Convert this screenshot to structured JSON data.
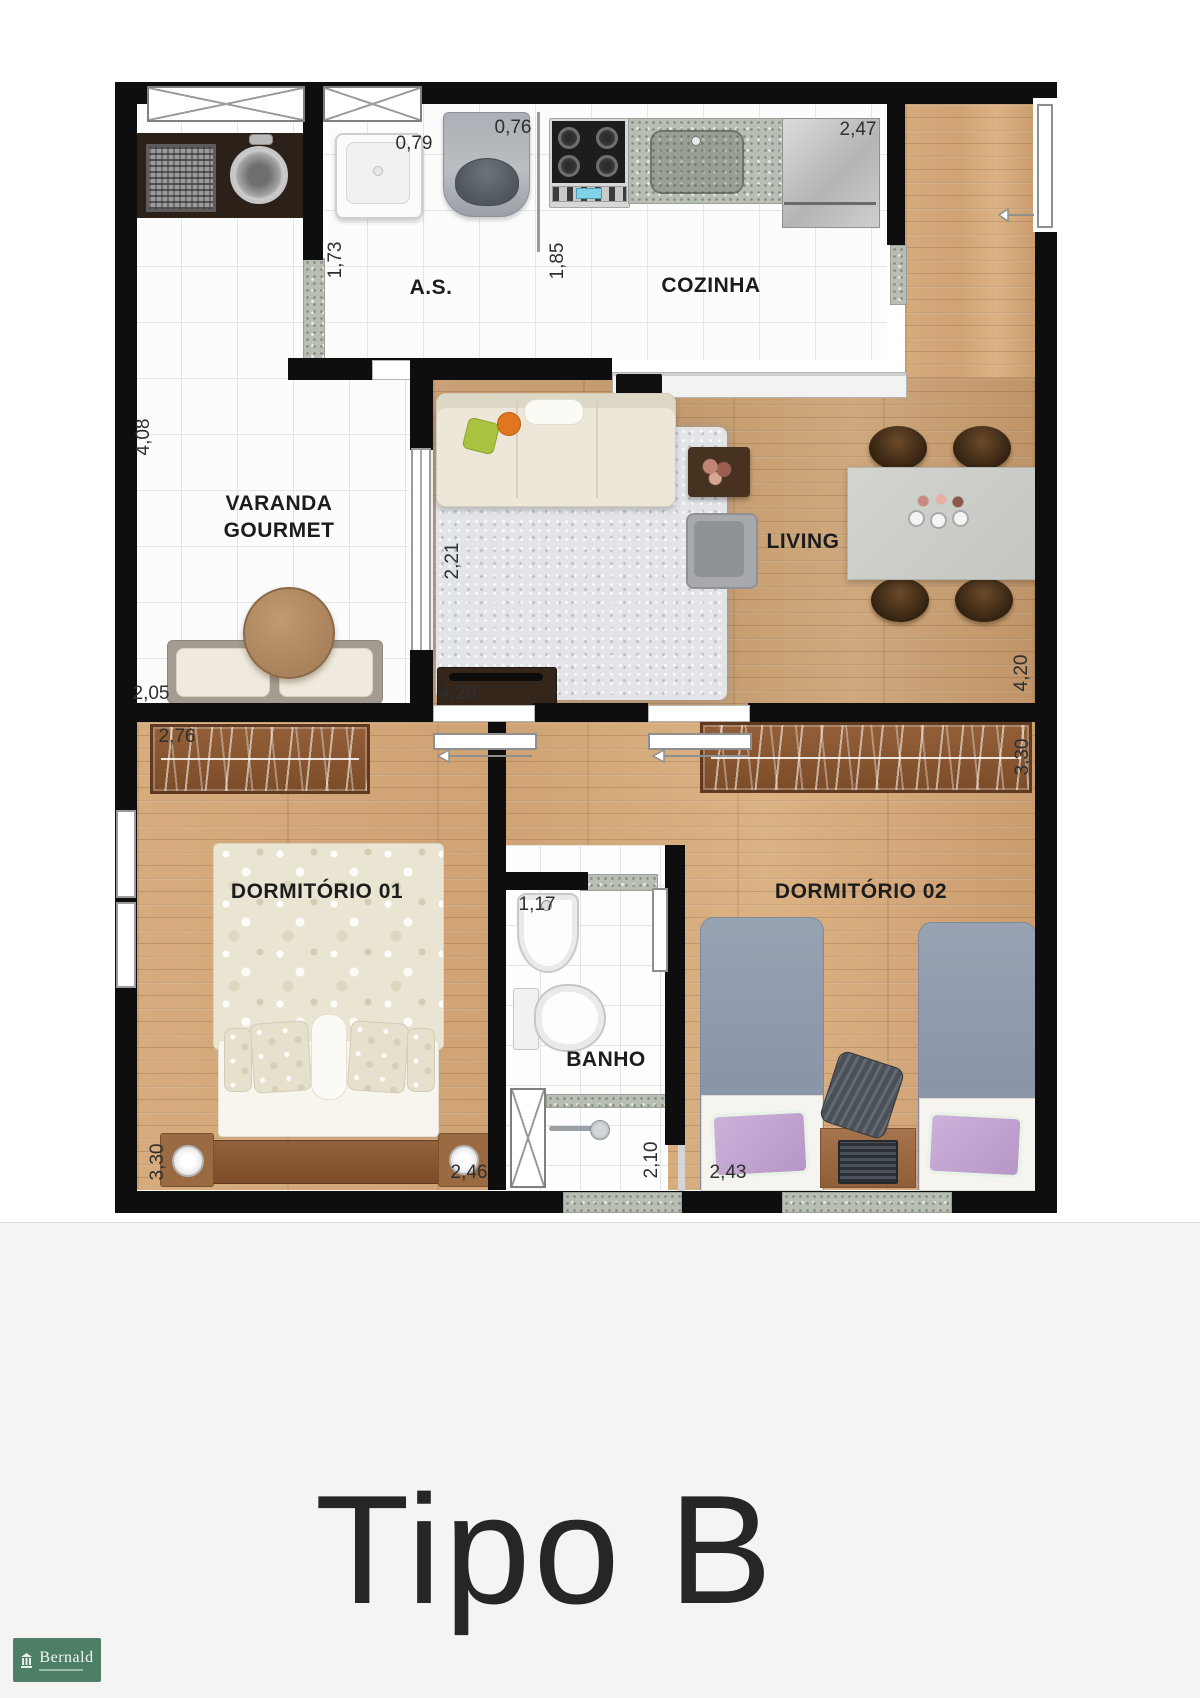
{
  "plan": {
    "room_labels": {
      "as": "A.S.",
      "cozinha": "COZINHA",
      "varanda": "VARANDA\nGOURMET",
      "living": "LIVING",
      "dormitorio1": "DORMITÓRIO 01",
      "dormitorio2": "DORMITÓRIO 02",
      "banho": "BANHO"
    },
    "dimensions": {
      "as_tanque": "0,79",
      "as_maquina": "0,76",
      "cozinha_width": "2,47",
      "as_left": "1,73",
      "cozinha_left": "1,85",
      "varanda_height": "4,08",
      "living_rug": "2,21",
      "varanda_width": "2,05",
      "living_width": "4,29",
      "living_height": "4,20",
      "dorm1_wardrobe": "2,76",
      "dorm2_wardrobe": "3,30",
      "banho_width": "1,17",
      "dorm1_height": "3,30",
      "dorm1_width": "2,46",
      "banho_height": "2,10",
      "dorm2_width": "2,43"
    }
  },
  "footer": {
    "title": "Tipo B"
  },
  "brand": {
    "name": "Bernald"
  },
  "colors": {
    "wall": "#0e0e0e",
    "wood_floor": "#c79f73",
    "tile_floor": "#fcfcfd",
    "granite": "#b9beb4",
    "brand_green": "#4c7f66",
    "title_text": "#262626",
    "label_text": "#1c1c1c"
  }
}
